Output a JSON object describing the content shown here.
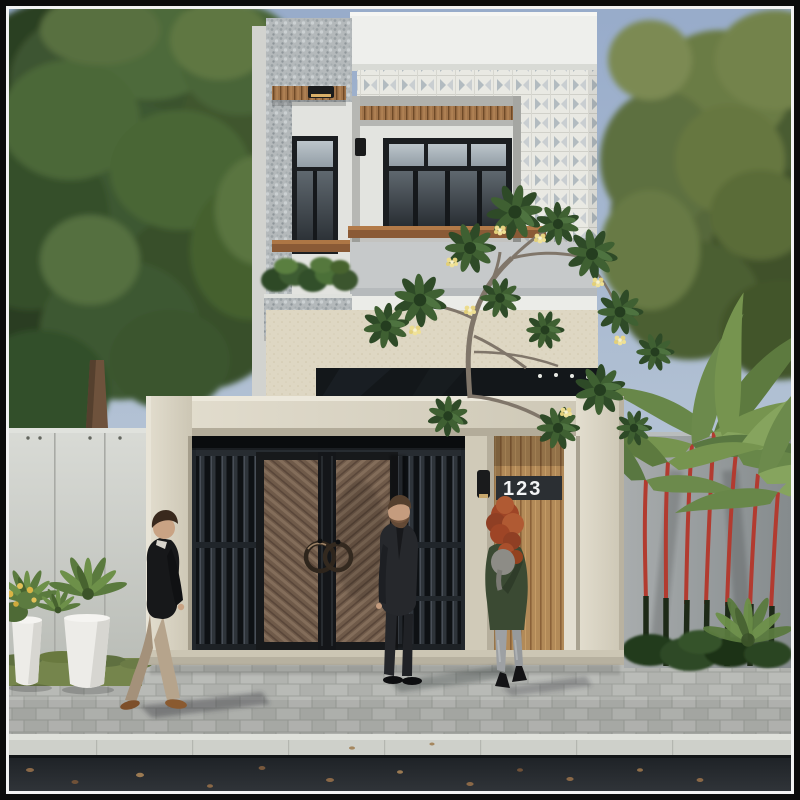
{
  "scene": {
    "type": "architectural exterior render",
    "house_number": "123",
    "figures": [
      "walking man",
      "man in suit",
      "woman with red hair"
    ],
    "elements": [
      "two-story modern townhouse",
      "breeze-block screen",
      "pebble-stone wall",
      "wood slat canopy",
      "balcony hedge planter",
      "metal slat gate",
      "bronze double entry doors",
      "wood slat pedestrian door",
      "wall lamp",
      "boundary walls",
      "lipstick palms",
      "frangipani tree",
      "street trees",
      "white planters with ferns",
      "paver driveway",
      "curb",
      "asphalt road with fallen leaves"
    ]
  },
  "colors": {
    "sky_top": "#97abca",
    "sky_bottom": "#ccd6e0",
    "facade_white": "#eeefec",
    "pebble_wall": "#b4b9bb",
    "breeze_block": "#e9e9e3",
    "cream_wall": "#ded7c3",
    "canopy_wood": "#a1744a",
    "wood_door": "#b28a58",
    "bronze_door": "#6f5a49",
    "metal_gate_slat": "#2e343a",
    "number_plate": "#2b2f33",
    "number_text": "#f3f4f5",
    "gate_frame": "#d8d2c2",
    "paver": "#b5b7b3",
    "curb": "#ced0ca",
    "road": "#24282c",
    "foliage_dark": "#33502a",
    "palm_stem_red": "#b23b30"
  }
}
